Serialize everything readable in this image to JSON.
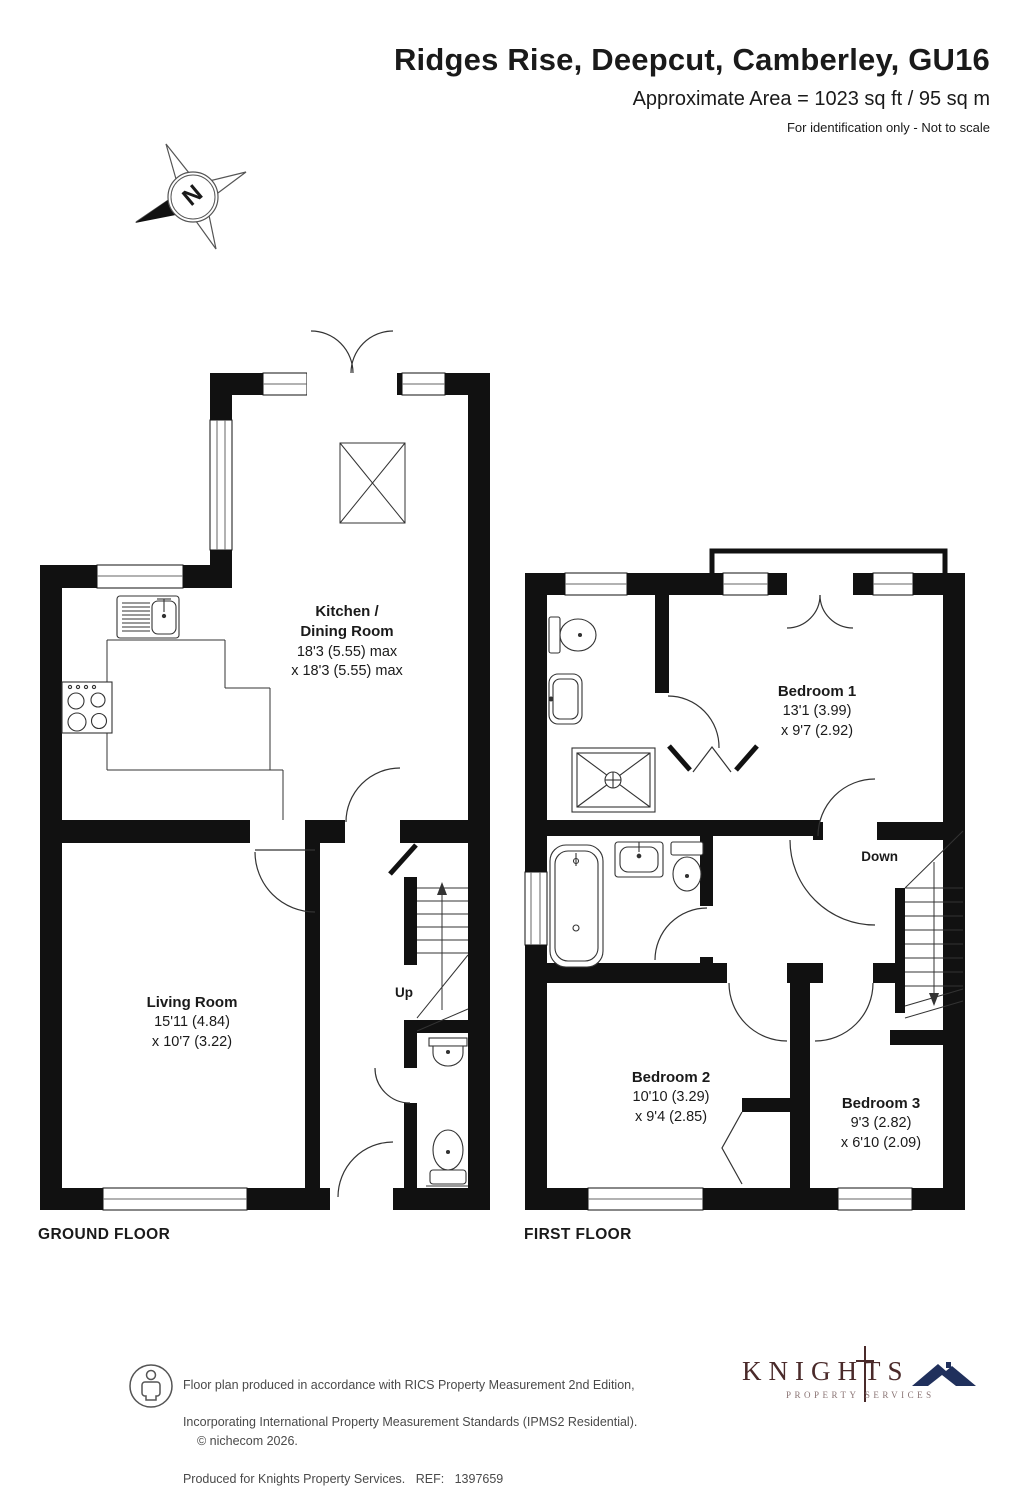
{
  "header": {
    "title": "Ridges Rise, Deepcut, Camberley, GU16",
    "area": "Approximate Area = 1023 sq ft / 95 sq m",
    "disclaimer": "For identification only - Not to scale"
  },
  "compass": {
    "north_label": "N"
  },
  "ground_floor": {
    "label": "GROUND FLOOR",
    "stairs_label": "Up",
    "rooms": {
      "kitchen": {
        "name": "Kitchen /\nDining Room",
        "dim1": "18'3 (5.55) max",
        "dim2": "x 18'3 (5.55) max"
      },
      "living": {
        "name": "Living Room",
        "dim1": "15'11 (4.84)",
        "dim2": "x 10'7 (3.22)"
      }
    }
  },
  "first_floor": {
    "label": "FIRST FLOOR",
    "stairs_label": "Down",
    "rooms": {
      "bedroom1": {
        "name": "Bedroom 1",
        "dim1": "13'1 (3.99)",
        "dim2": "x 9'7 (2.92)"
      },
      "bedroom2": {
        "name": "Bedroom 2",
        "dim1": "10'10 (3.29)",
        "dim2": "x 9'4 (2.85)"
      },
      "bedroom3": {
        "name": "Bedroom 3",
        "dim1": "9'3 (2.82)",
        "dim2": "x 6'10 (2.09)"
      }
    }
  },
  "footer": {
    "line1": "Floor plan produced in accordance with RICS Property Measurement 2nd Edition,",
    "line2": "Incorporating International Property Measurement Standards (IPMS2 Residential).",
    "copyright": "© nichecom 2026.",
    "line3": "Produced for Knights Property Services.   REF:   1397659",
    "brand": {
      "name": "KNIGHTS",
      "tagline": "PROPERTY  SERVICES"
    }
  }
}
